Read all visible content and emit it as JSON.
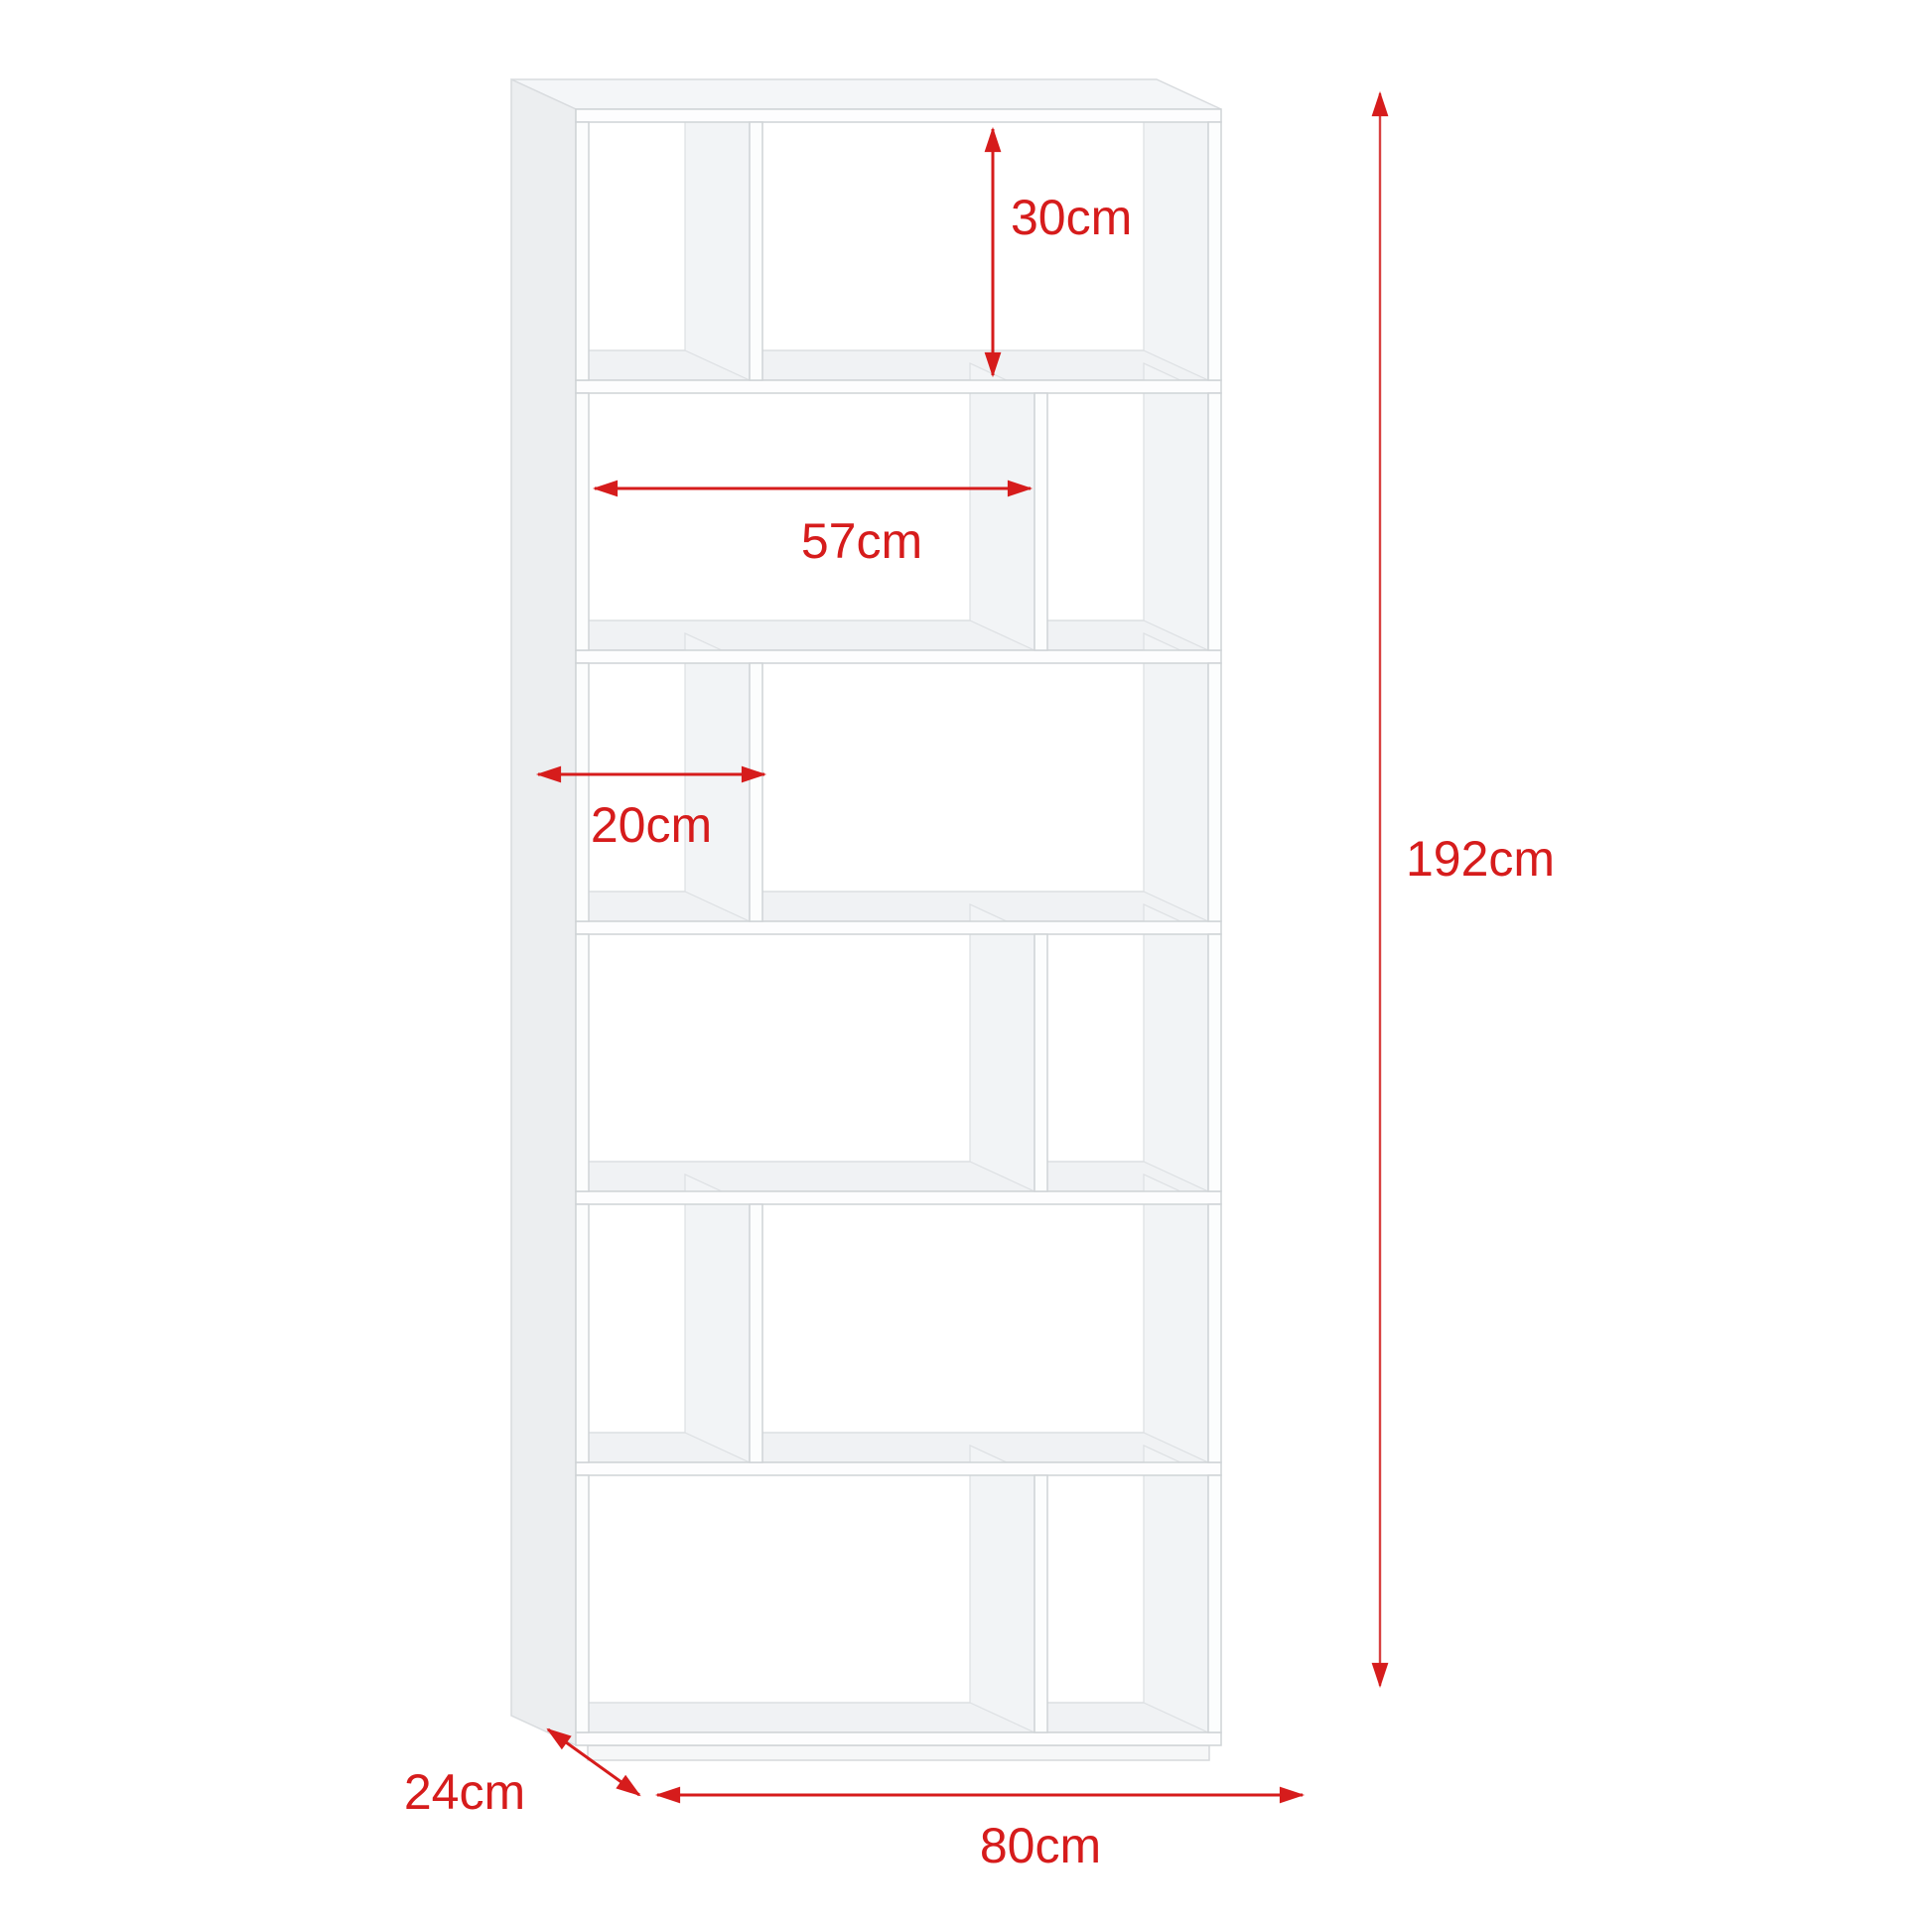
{
  "diagram": {
    "subject": "s-shaped-bookcase-6-tiers",
    "background_color": "#ffffff",
    "furniture_color": "#ffffff",
    "edge_color": "#cfd3d6",
    "dimension_color": "#d61c1c",
    "dimensions": {
      "inner_height": {
        "label": "30cm",
        "orientation": "vertical",
        "measures": "compartment inner height"
      },
      "inner_width": {
        "label": "57cm",
        "orientation": "horizontal",
        "measures": "open span width"
      },
      "compartment_width": {
        "label": "20cm",
        "orientation": "horizontal",
        "measures": "side compartment width"
      },
      "total_height": {
        "label": "192cm",
        "orientation": "vertical",
        "measures": "overall height"
      },
      "depth": {
        "label": "24cm",
        "orientation": "diagonal",
        "measures": "overall depth"
      },
      "total_width": {
        "label": "80cm",
        "orientation": "horizontal",
        "measures": "overall width"
      }
    }
  }
}
